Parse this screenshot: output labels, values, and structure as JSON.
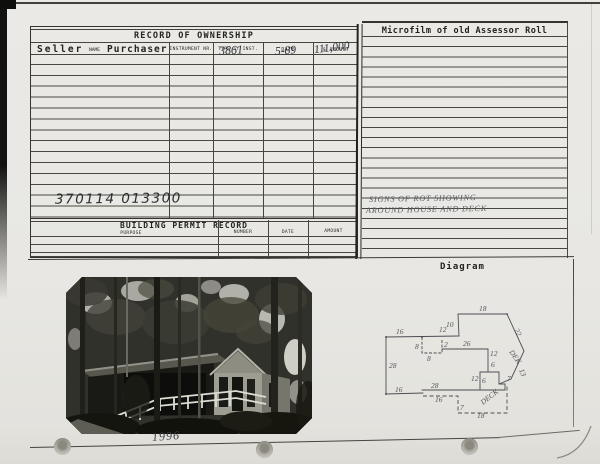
{
  "ownership": {
    "title": "RECORD OF OWNERSHIP",
    "columns": {
      "seller": "Seller",
      "name": "NAME",
      "purchaser": "Purchaser",
      "instrument": "INSTRUMENT NR.",
      "type": "TYPE of INST.",
      "date": "DATE",
      "amount": "$ AMOUNT"
    },
    "entry": {
      "type_of_inst": "3861",
      "date": "5-89",
      "amount": "111,000"
    },
    "parcel_number": "370114  013300"
  },
  "building_permit": {
    "title": "BUILDING PERMIT RECORD",
    "columns": [
      "PURPOSE",
      "NUMBER",
      "DATE",
      "AMOUNT"
    ]
  },
  "microfilm": {
    "title": "Microfilm of old Assessor Roll",
    "note_line1": "SIGNS OF ROT  SHOWING",
    "note_line2": "AROUND HOUSE AND DECK"
  },
  "diagram": {
    "title": "Diagram",
    "labels": [
      {
        "t": "16",
        "x": 396,
        "y": 334
      },
      {
        "t": "12",
        "x": 439,
        "y": 332
      },
      {
        "t": "10",
        "x": 446,
        "y": 327
      },
      {
        "t": "18",
        "x": 479,
        "y": 311
      },
      {
        "t": "22",
        "x": 514,
        "y": 330,
        "r": 62
      },
      {
        "t": "8",
        "x": 415,
        "y": 349
      },
      {
        "t": "8",
        "x": 427,
        "y": 361
      },
      {
        "t": "2",
        "x": 444,
        "y": 347
      },
      {
        "t": "26",
        "x": 463,
        "y": 346
      },
      {
        "t": "12",
        "x": 490,
        "y": 356
      },
      {
        "t": "6",
        "x": 491,
        "y": 367
      },
      {
        "t": "DEK",
        "x": 509,
        "y": 352,
        "r": 55
      },
      {
        "t": "13",
        "x": 519,
        "y": 370,
        "r": 68
      },
      {
        "t": "12",
        "x": 471,
        "y": 381
      },
      {
        "t": "6",
        "x": 482,
        "y": 383
      },
      {
        "t": "7",
        "x": 507,
        "y": 381
      },
      {
        "t": "28",
        "x": 389,
        "y": 368
      },
      {
        "t": "16",
        "x": 395,
        "y": 392
      },
      {
        "t": "28",
        "x": 431,
        "y": 388
      },
      {
        "t": "16",
        "x": 435,
        "y": 402
      },
      {
        "t": "7",
        "x": 460,
        "y": 410
      },
      {
        "t": "18",
        "x": 477,
        "y": 418
      },
      {
        "t": "DECK",
        "x": 483,
        "y": 405,
        "r": -38
      }
    ]
  },
  "photo": {
    "caption": "1996"
  }
}
